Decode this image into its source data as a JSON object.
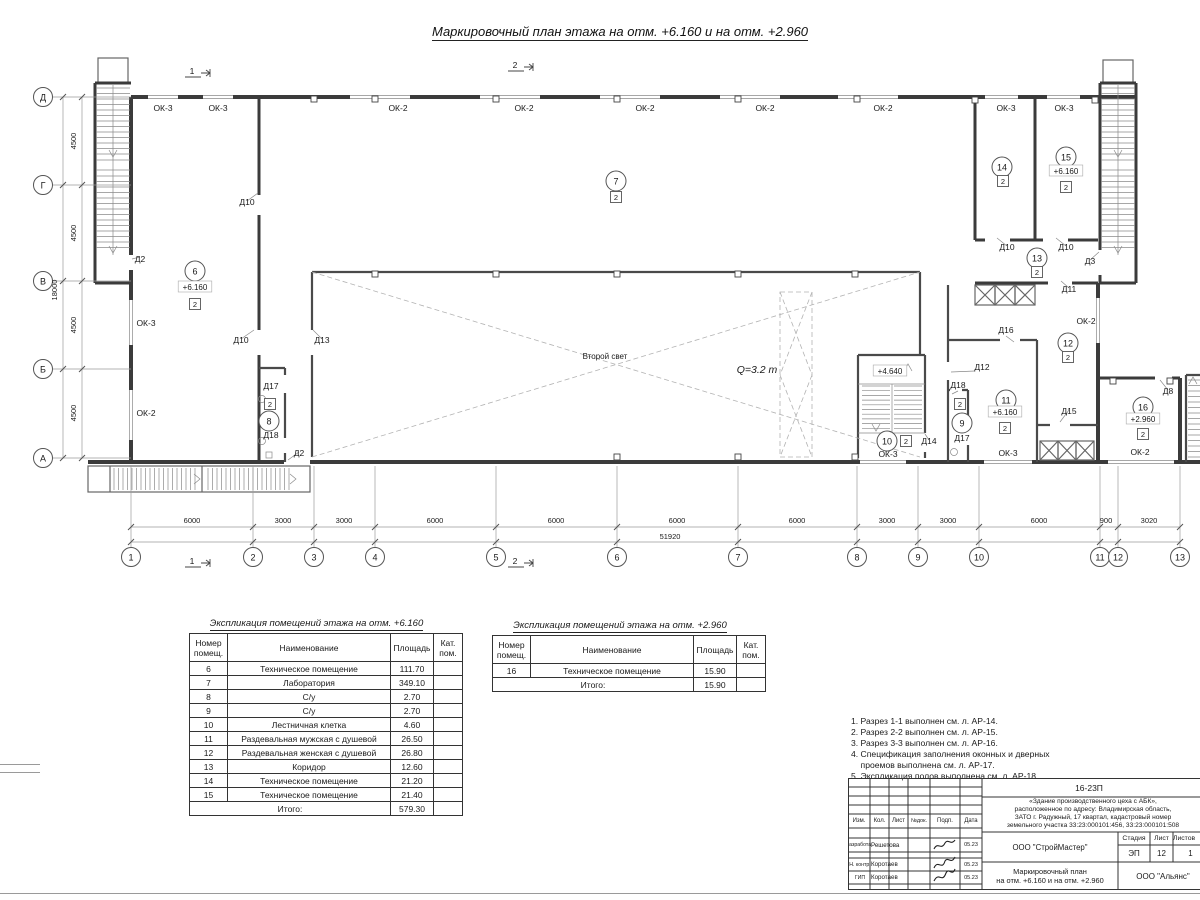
{
  "page": {
    "title": "Маркировочный план этажа на отм. +6.160 и на отм. +2.960"
  },
  "plan": {
    "axes_bottom": [
      {
        "n": "1",
        "x": 131
      },
      {
        "n": "2",
        "x": 253
      },
      {
        "n": "3",
        "x": 314
      },
      {
        "n": "4",
        "x": 375
      },
      {
        "n": "5",
        "x": 496
      },
      {
        "n": "6",
        "x": 617
      },
      {
        "n": "7",
        "x": 738
      },
      {
        "n": "8",
        "x": 857
      },
      {
        "n": "9",
        "x": 918
      },
      {
        "n": "10",
        "x": 979
      },
      {
        "n": "11",
        "x": 1100
      },
      {
        "n": "12",
        "x": 1118
      },
      {
        "n": "13",
        "x": 1180
      }
    ],
    "axes_left": [
      {
        "n": "Д",
        "y": 97
      },
      {
        "n": "Г",
        "y": 185
      },
      {
        "n": "В",
        "y": 281
      },
      {
        "n": "Б",
        "y": 369
      },
      {
        "n": "А",
        "y": 458
      }
    ],
    "dims_bottom": [
      {
        "t": "6000",
        "x": 192
      },
      {
        "t": "3000",
        "x": 283
      },
      {
        "t": "3000",
        "x": 344
      },
      {
        "t": "6000",
        "x": 435
      },
      {
        "t": "6000",
        "x": 556
      },
      {
        "t": "6000",
        "x": 677
      },
      {
        "t": "6000",
        "x": 797
      },
      {
        "t": "3000",
        "x": 887
      },
      {
        "t": "3000",
        "x": 948
      },
      {
        "t": "6000",
        "x": 1039
      },
      {
        "t": "900",
        "x": 1106
      },
      {
        "t": "3020",
        "x": 1149
      }
    ],
    "total_bottom": {
      "t": "51920",
      "x": 670
    },
    "dims_left": [
      {
        "t": "4500",
        "y": 141
      },
      {
        "t": "4500",
        "y": 233
      },
      {
        "t": "4500",
        "y": 325
      },
      {
        "t": "4500",
        "y": 413
      }
    ],
    "total_left": {
      "t": "18000",
      "y": 290
    },
    "sections": [
      {
        "n": "1",
        "x": 196,
        "y": 70
      },
      {
        "n": "2",
        "x": 519,
        "y": 64
      },
      {
        "n": "1",
        "x": 196,
        "y": 560
      },
      {
        "n": "2",
        "x": 519,
        "y": 560
      }
    ],
    "circles": [
      {
        "n": "6",
        "x": 195,
        "y": 271
      },
      {
        "n": "7",
        "x": 616,
        "y": 181
      },
      {
        "n": "8",
        "x": 269,
        "y": 421
      },
      {
        "n": "9",
        "x": 962,
        "y": 423
      },
      {
        "n": "10",
        "x": 887,
        "y": 441
      },
      {
        "n": "11",
        "x": 1006,
        "y": 400
      },
      {
        "n": "12",
        "x": 1068,
        "y": 343
      },
      {
        "n": "13",
        "x": 1037,
        "y": 258
      },
      {
        "n": "14",
        "x": 1002,
        "y": 167
      },
      {
        "n": "15",
        "x": 1066,
        "y": 157
      },
      {
        "n": "16",
        "x": 1143,
        "y": 407
      }
    ],
    "badges": [
      {
        "t": "2",
        "x": 195,
        "y": 304
      },
      {
        "t": "2",
        "x": 616,
        "y": 197
      },
      {
        "t": "2",
        "x": 270,
        "y": 404
      },
      {
        "t": "2",
        "x": 960,
        "y": 404
      },
      {
        "t": "2",
        "x": 906,
        "y": 441
      },
      {
        "t": "2",
        "x": 1005,
        "y": 428
      },
      {
        "t": "2",
        "x": 1068,
        "y": 357
      },
      {
        "t": "2",
        "x": 1037,
        "y": 272
      },
      {
        "t": "2",
        "x": 1003,
        "y": 181
      },
      {
        "t": "2",
        "x": 1066,
        "y": 187
      },
      {
        "t": "2",
        "x": 1143,
        "y": 434
      }
    ],
    "elevations": [
      {
        "t": "+6.160",
        "x": 195,
        "y": 289
      },
      {
        "t": "+6.160",
        "x": 1005,
        "y": 414
      },
      {
        "t": "+6.160",
        "x": 1066,
        "y": 173
      },
      {
        "t": "+2.960",
        "x": 1143,
        "y": 421
      },
      {
        "t": "+4.640",
        "x": 890,
        "y": 373
      }
    ],
    "labels": [
      {
        "t": "ОК-3",
        "x": 163,
        "y": 111
      },
      {
        "t": "ОК-3",
        "x": 218,
        "y": 111
      },
      {
        "t": "ОК-2",
        "x": 398,
        "y": 111
      },
      {
        "t": "ОК-2",
        "x": 524,
        "y": 111
      },
      {
        "t": "ОК-2",
        "x": 645,
        "y": 111
      },
      {
        "t": "ОК-2",
        "x": 765,
        "y": 111
      },
      {
        "t": "ОК-2",
        "x": 883,
        "y": 111
      },
      {
        "t": "ОК-3",
        "x": 1006,
        "y": 111
      },
      {
        "t": "ОК-3",
        "x": 1064,
        "y": 111
      },
      {
        "t": "ОК-3",
        "x": 146,
        "y": 326
      },
      {
        "t": "ОК-2",
        "x": 146,
        "y": 416
      },
      {
        "t": "ОК-3",
        "x": 888,
        "y": 457
      },
      {
        "t": "ОК-3",
        "x": 1008,
        "y": 456
      },
      {
        "t": "ОК-2",
        "x": 1140,
        "y": 455
      },
      {
        "t": "ОК-2",
        "x": 1086,
        "y": 324
      },
      {
        "t": "Д2",
        "x": 140,
        "y": 262
      },
      {
        "t": "Д10",
        "x": 247,
        "y": 205
      },
      {
        "t": "Д10",
        "x": 241,
        "y": 343
      },
      {
        "t": "Д13",
        "x": 322,
        "y": 343
      },
      {
        "t": "Д17",
        "x": 271,
        "y": 389
      },
      {
        "t": "Д18",
        "x": 271,
        "y": 438
      },
      {
        "t": "Д2",
        "x": 299,
        "y": 456
      },
      {
        "t": "Д14",
        "x": 929,
        "y": 444
      },
      {
        "t": "Д18",
        "x": 958,
        "y": 388
      },
      {
        "t": "Д17",
        "x": 962,
        "y": 441
      },
      {
        "t": "Д12",
        "x": 982,
        "y": 370
      },
      {
        "t": "Д16",
        "x": 1006,
        "y": 333
      },
      {
        "t": "Д11",
        "x": 1069,
        "y": 292
      },
      {
        "t": "Д10",
        "x": 1007,
        "y": 250
      },
      {
        "t": "Д10",
        "x": 1066,
        "y": 250
      },
      {
        "t": "Д3",
        "x": 1090,
        "y": 264
      },
      {
        "t": "Д15",
        "x": 1069,
        "y": 414
      },
      {
        "t": "Д8",
        "x": 1168,
        "y": 394
      }
    ],
    "texts": [
      {
        "t": "Второй свет",
        "x": 605,
        "y": 359,
        "cls": "small"
      },
      {
        "t": "Q=3.2 т",
        "x": 757,
        "y": 373,
        "cls": "qital"
      }
    ]
  },
  "explication1": {
    "title": "Экспликация помещений этажа на отм. +6.160",
    "headers": [
      "Номер помещ.",
      "Наименование",
      "Площадь",
      "Кат. пом."
    ],
    "rows": [
      [
        "6",
        "Техническое помещение",
        "111.70",
        ""
      ],
      [
        "7",
        "Лаборатория",
        "349.10",
        ""
      ],
      [
        "8",
        "С/у",
        "2.70",
        ""
      ],
      [
        "9",
        "С/у",
        "2.70",
        ""
      ],
      [
        "10",
        "Лестничная клетка",
        "4.60",
        ""
      ],
      [
        "11",
        "Раздевальная мужская с душевой",
        "26.50",
        ""
      ],
      [
        "12",
        "Раздевальная женская с душевой",
        "26.80",
        ""
      ],
      [
        "13",
        "Коридор",
        "12.60",
        ""
      ],
      [
        "14",
        "Техническое помещение",
        "21.20",
        ""
      ],
      [
        "15",
        "Техническое помещение",
        "21.40",
        ""
      ]
    ],
    "total_label": "Итого:",
    "total_value": "579.30"
  },
  "explication2": {
    "title": "Экспликация помещений этажа на отм. +2.960",
    "headers": [
      "Номер помещ.",
      "Наименование",
      "Площадь",
      "Кат. пом."
    ],
    "rows": [
      [
        "16",
        "Техническое помещение",
        "15.90",
        ""
      ]
    ],
    "total_label": "Итого:",
    "total_value": "15.90"
  },
  "notes": {
    "lines": [
      "1. Разрез 1-1 выполнен см. л. АР-14.",
      "2. Разрез 2-2 выполнен см. л. АР-15.",
      "3. Разрез 3-3 выполнен см. л. АР-16.",
      "4. Спецификация заполнения оконных и дверных",
      "    проемов выполнена см. л. АР-17.",
      "5. Экспликация полов выполнена см. л. АР-18."
    ]
  },
  "titleblock": {
    "code": "16-23П",
    "description": [
      "«Здание производственного цеха с АБК»,",
      "расположенное по адресу: Владимирская область,",
      "ЗАТО г. Радужный, 17 квартал, кадастровый номер",
      "земельного участка 33:23:000101:456, 33:23:000101:508"
    ],
    "cols": [
      "Изм.",
      "Кол.",
      "Лист",
      "№док.",
      "Подп.",
      "Дата"
    ],
    "sign_rows": [
      {
        "role": "Разработал",
        "name": "Решетова",
        "date": "05.23"
      },
      {
        "role": "Н. контр.",
        "name": "Коротаев",
        "date": "05.23"
      },
      {
        "role": "ГИП",
        "name": "Коротаев",
        "date": "05.23"
      }
    ],
    "org1": "ООО \"СтройМастер\"",
    "stage_headers": [
      "Стадия",
      "Лист",
      "Листов"
    ],
    "stage_values": [
      "ЭП",
      "12",
      "1"
    ],
    "doc_name": [
      "Маркировочный план",
      "на отм. +6.160 и на отм. +2.960"
    ],
    "org2": "ООО \"Альянс\""
  }
}
